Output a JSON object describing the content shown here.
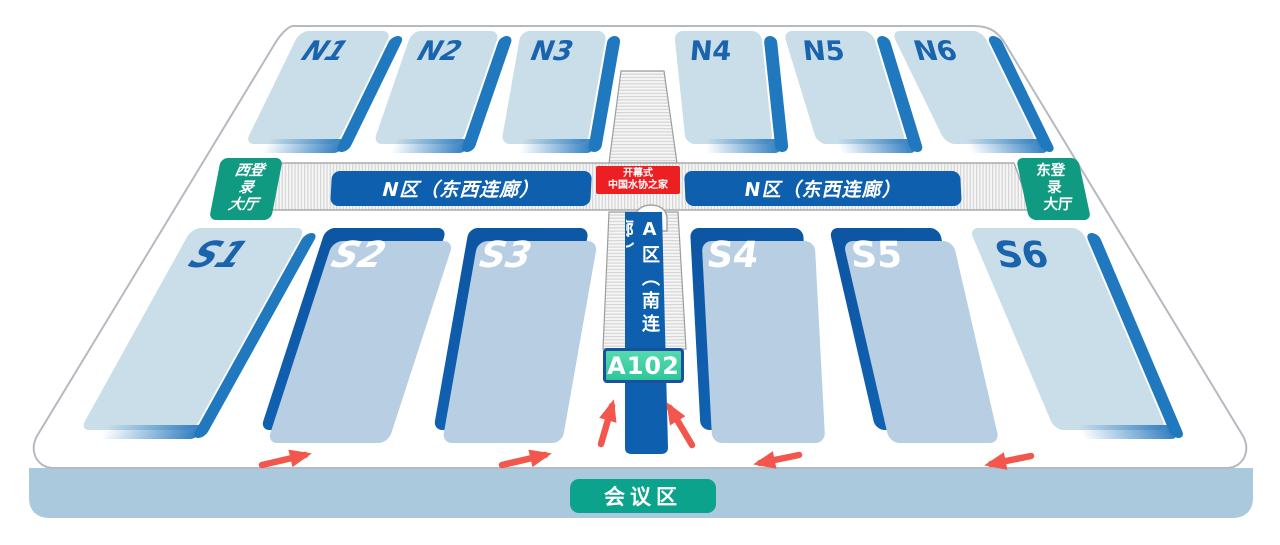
{
  "halls": {
    "north": [
      {
        "label": "N1"
      },
      {
        "label": "N2"
      },
      {
        "label": "N3"
      },
      {
        "label": "N4"
      },
      {
        "label": "N5"
      },
      {
        "label": "N6"
      }
    ],
    "south": [
      {
        "label": "S1"
      },
      {
        "label": "S2"
      },
      {
        "label": "S3"
      },
      {
        "label": "S4"
      },
      {
        "label": "S5"
      },
      {
        "label": "S6"
      }
    ]
  },
  "corridor": {
    "west_wing_label": "N区（东西连廊）",
    "east_wing_label": "N区（东西连廊）",
    "south_label": "A区（南连廊）"
  },
  "entrances": {
    "west": {
      "lines": [
        "西登",
        "录",
        "大厅"
      ]
    },
    "east": {
      "lines": [
        "东登",
        "录",
        "大厅"
      ]
    }
  },
  "center_banner": {
    "line1": "开幕式",
    "line2": "中国水协之家"
  },
  "badge": {
    "label": "A102"
  },
  "conference": {
    "label": "会议区"
  },
  "icons": {
    "flow_arrow_right": "→",
    "flow_arrow_left": "←",
    "flow_arrow_up": "↑"
  },
  "colors": {
    "hall_light": "#c9dee9",
    "hall_dark": "#0e5aa7",
    "hall_accent_edge": "#2079bf",
    "hall_shadow": "#b7cee3",
    "corridor_label_bg": "#0e5fae",
    "banner_red": "#ec1f23",
    "entrance_teal": "#109a82",
    "badge_green": "#3ed0a2",
    "badge_border": "#1c4f9e",
    "platform_side": "#abc9dd",
    "arrow_red": "#f2564c"
  }
}
